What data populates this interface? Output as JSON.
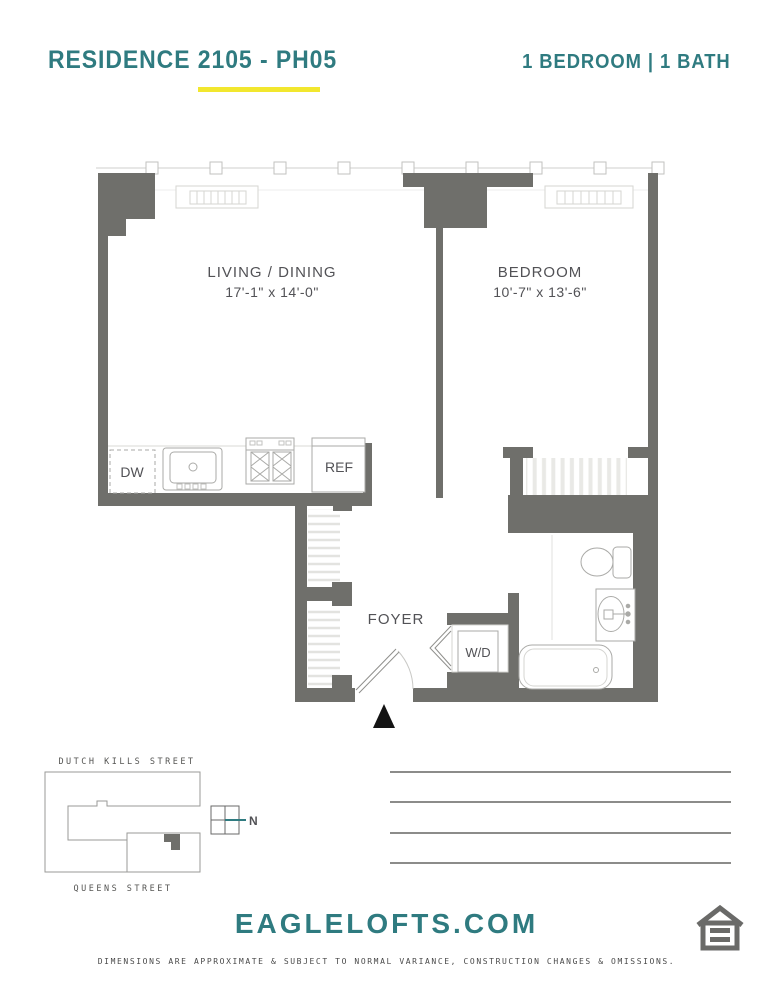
{
  "header": {
    "title": "RESIDENCE 2105 - PH05",
    "subtitle": "1 BEDROOM | 1 BATH"
  },
  "plan": {
    "living": {
      "name": "LIVING / DINING",
      "dims": "17'-1\" x 14'-0\""
    },
    "bedroom": {
      "name": "BEDROOM",
      "dims": "10'-7\" x 13'-6\""
    },
    "foyer": {
      "name": "FOYER"
    },
    "appliances": {
      "dishwasher": "DW",
      "refrigerator": "REF",
      "washer_dryer": "W/D"
    }
  },
  "sitemap": {
    "street_top": "DUTCH KILLS STREET",
    "street_bottom": "QUEENS STREET",
    "north_label": "N"
  },
  "footer": {
    "website": "EAGLELOFTS.COM",
    "disclaimer": "DIMENSIONS ARE APPROXIMATE & SUBJECT TO NORMAL VARIANCE, CONSTRUCTION CHANGES & OMISSIONS."
  },
  "colors": {
    "teal": "#2F7B80",
    "yellow": "#F2E72E",
    "wall_gray": "#6F6F6B"
  }
}
